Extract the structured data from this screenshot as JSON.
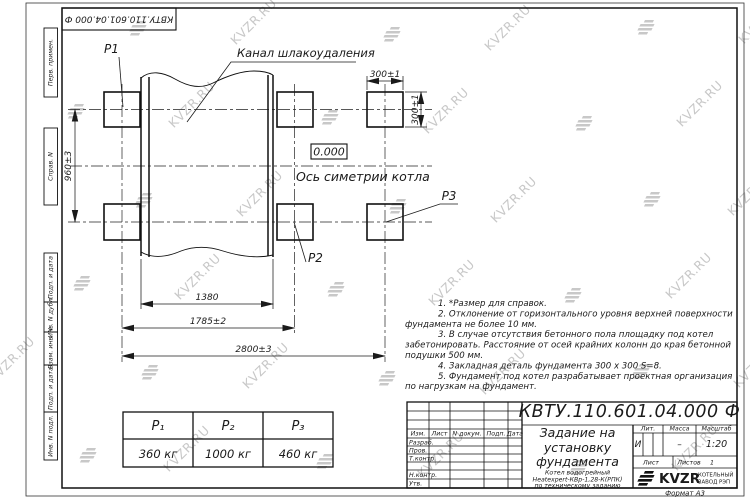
{
  "sheet": {
    "designation_rotated": "КВТУ.110.601.04.000 Ф",
    "format_label": "Формат А3",
    "watermark_text": "KVZR.RU",
    "watermark_color": "#c8c8c8"
  },
  "margin_labels": [
    "Перв. примен.",
    "Справ. N",
    "Подп. и дата",
    "Инв. N дубл.",
    "Взам. инв. N",
    "Подп. и дата",
    "Инв. N подл."
  ],
  "drawing": {
    "p1": "P1",
    "p2": "P2",
    "p3": "P3",
    "channel_label": "Канал шлакоудаления",
    "elevation": "0.000",
    "axis_label": "Ось симетрии котла",
    "dims": {
      "pad_w": "300±1",
      "pad_h": "300±1",
      "row_span": "960±3",
      "d1380": "1380",
      "d1785": "1785±2",
      "d2800": "2800±3"
    }
  },
  "notes": [
    "1.  *Размер для справок.",
    "2.  Отклонение от горизонтального уровня верхней поверхности",
    "фундамента не более 10 мм.",
    "3.  В случае отсутствия бетонного пола площадку под котел",
    "забетонировать. Расстояние от осей крайних колонн до края бетонной",
    "подушки 500 мм.",
    "4.  Закладная деталь фундамента  300 x 300 S=8.",
    "5.  Фундамент под котел разрабатывает проектная организация",
    "по нагрузкам на фундамент."
  ],
  "load_table": {
    "headers": [
      "P₁",
      "P₂",
      "P₃"
    ],
    "values": [
      "360 кг",
      "1000 кг",
      "460 кг"
    ]
  },
  "title_block": {
    "designation": "КВТУ.110.601.04.000 Ф",
    "title_lines": [
      "Задание на",
      "установку",
      "фундамента"
    ],
    "subtitle_lines": [
      "Котел водогрейный",
      "Heatexpert-КВр-1,28-К(РПК)",
      "по техническому заданию"
    ],
    "col_headers": [
      "Изм.",
      "Лист",
      "N докум.",
      "Подп.",
      "Дата"
    ],
    "row_labels": [
      "Разраб.",
      "Пров.",
      "Т.контр.",
      "Н.контр.",
      "Утв."
    ],
    "lit_label": "Лит.",
    "lit_value": "И",
    "mass_label": "Масса",
    "mass_value": "–",
    "scale_label": "Масштаб",
    "scale_value": "1:20",
    "sheet_label": "Лист",
    "sheets_label": "Листов",
    "sheets_value": "1",
    "company_name": "KVZR",
    "company_line1": "КОТЕЛЬНЫЙ",
    "company_line2": "ЗАВОД РЭП"
  }
}
